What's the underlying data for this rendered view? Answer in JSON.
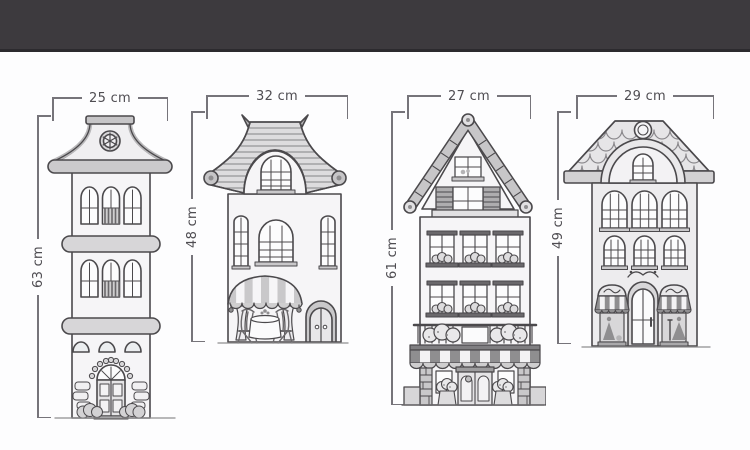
{
  "page": {
    "background": "#fdfdfe",
    "top_bar_color": "#3d3a3e",
    "line_color": "#4b494c",
    "dimension_line_color": "#76747a",
    "unit": "cm"
  },
  "diagram": {
    "houses": [
      {
        "name": "pagoda-roof-tower-house",
        "width_label": "25 cm",
        "height_label": "63 cm",
        "width_cm": 25,
        "height_cm": 63
      },
      {
        "name": "curved-roof-cafe-house",
        "width_label": "32 cm",
        "height_label": "48 cm",
        "width_cm": 32,
        "height_cm": 48
      },
      {
        "name": "gable-roof-bakery-house",
        "width_label": "27 cm",
        "height_label": "61 cm",
        "width_cm": 27,
        "height_cm": 61
      },
      {
        "name": "scalloped-roof-boutique-house",
        "width_label": "29 cm",
        "height_label": "49 cm",
        "width_cm": 29,
        "height_cm": 49
      }
    ]
  }
}
